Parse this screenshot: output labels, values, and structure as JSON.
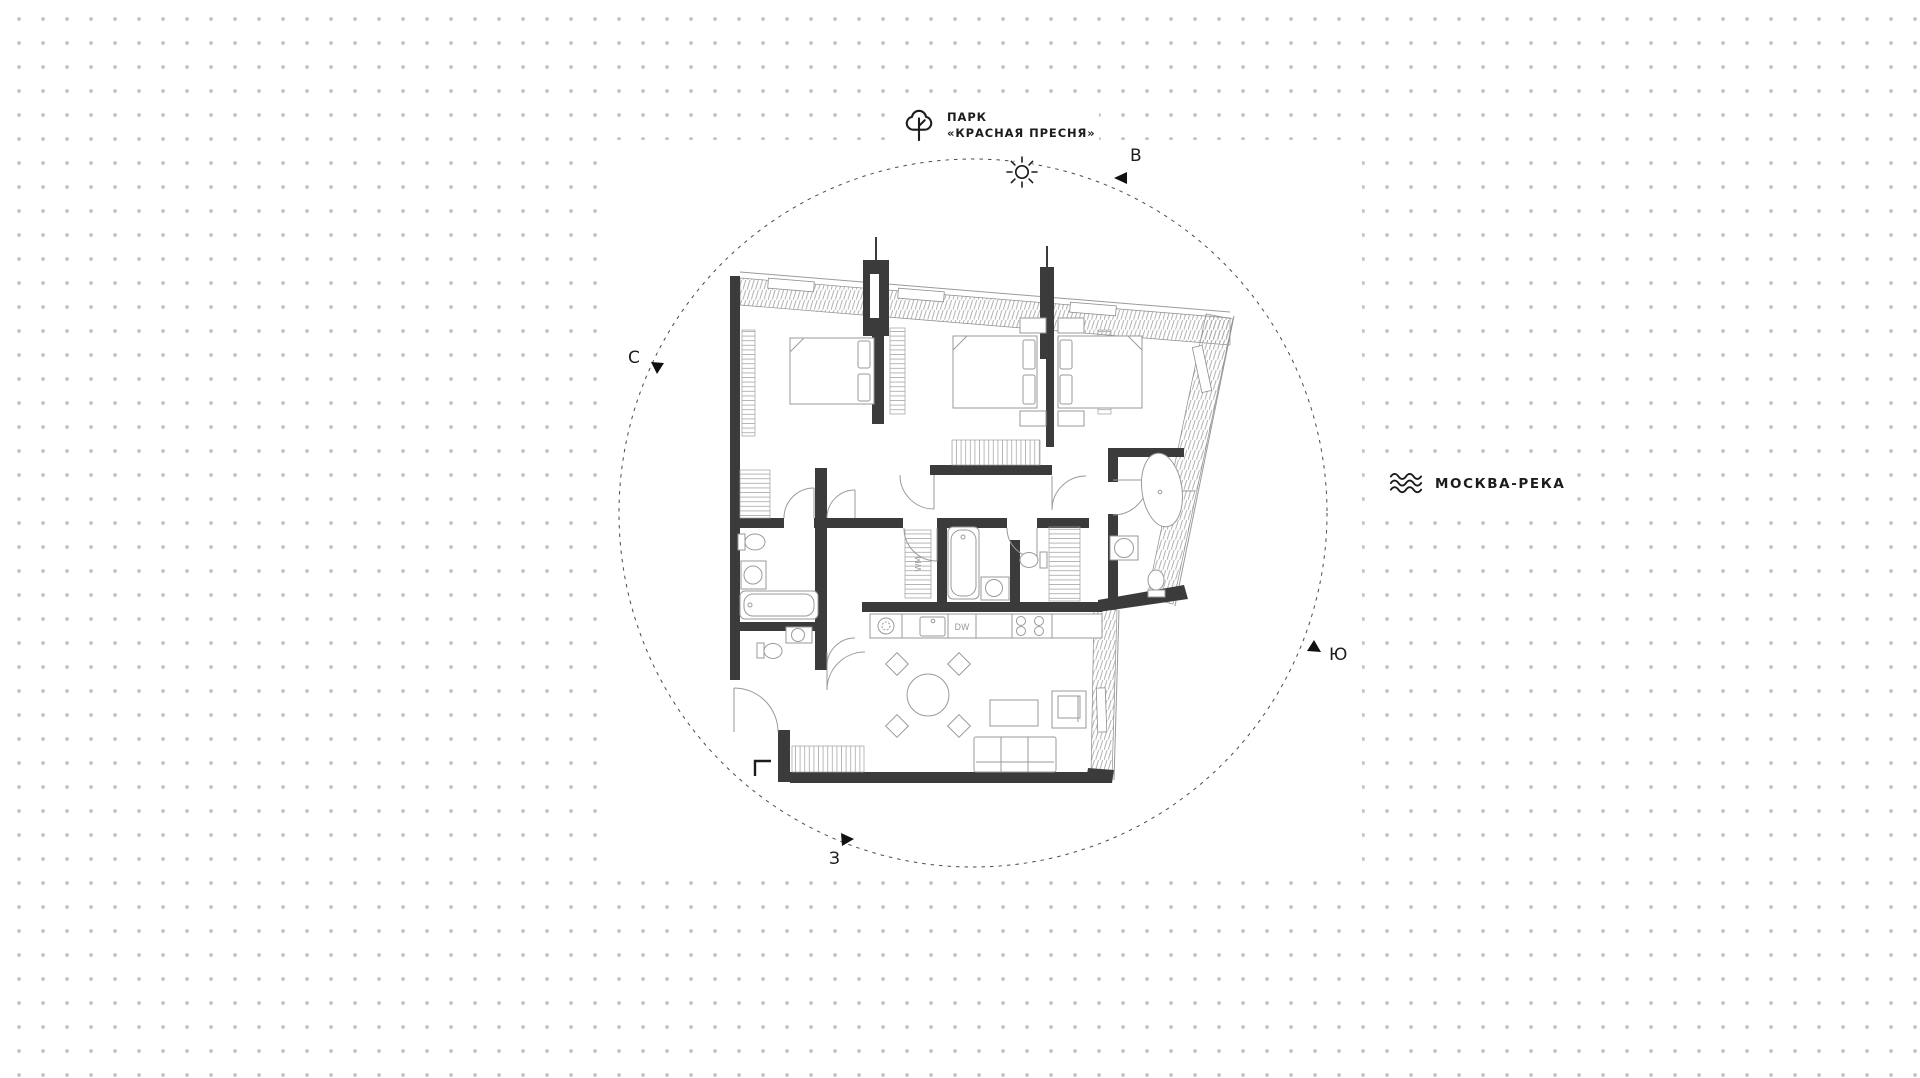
{
  "canvas": {
    "dot_color": "#c5c5c5",
    "wall_color": "#3b3b3b",
    "furniture_line_color": "#9a9a9a"
  },
  "labels": {
    "park": {
      "line1": "ПАРК",
      "line2": "«КРАСНАЯ ПРЕСНЯ»",
      "icon": "tree-icon"
    },
    "river": {
      "text": "МОСКВА-РЕКА",
      "icon": "waves-icon"
    },
    "sun": {
      "icon": "sun-icon"
    }
  },
  "compass": {
    "north": "С",
    "east": "В",
    "south": "Ю",
    "west": "З"
  },
  "plan": {
    "type": "apartment-floor-plan",
    "washing_machine_label": "WM",
    "dishwasher_label": "DW"
  }
}
